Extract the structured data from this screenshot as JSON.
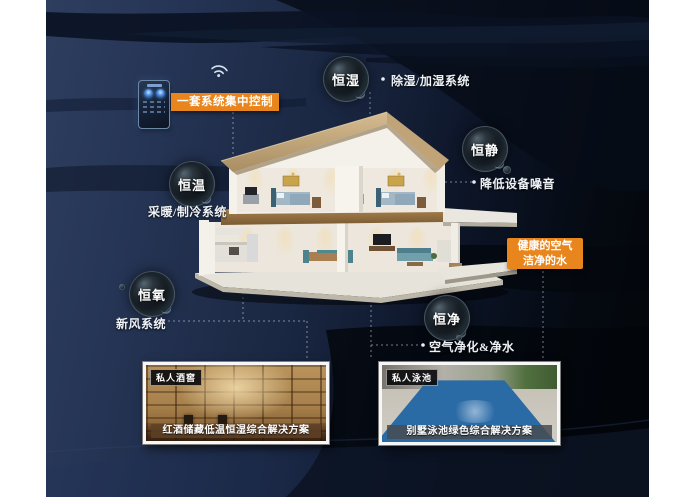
{
  "poster": {
    "control_badge": "一套系统集中控制",
    "health_badge": {
      "line1": "健康的空气",
      "line2": "洁净的水"
    },
    "bubbles": [
      {
        "label": "恒湿",
        "note": "除湿/加湿系统"
      },
      {
        "label": "恒静",
        "note": "降低设备噪音"
      },
      {
        "label": "恒温",
        "note": "采暖/制冷系统"
      },
      {
        "label": "恒氧",
        "note": "新风系统"
      },
      {
        "label": "恒净",
        "note": "空气净化&净水"
      }
    ],
    "cards": [
      {
        "tag": "私人酒窖",
        "caption": "红酒储藏低温恒湿综合解决方案"
      },
      {
        "tag": "私人泳池",
        "caption": "别墅泳池绿色综合解决方案"
      }
    ],
    "icons": {
      "wifi": "wifi-icon",
      "phone": "smart-control-phone"
    },
    "colors": {
      "accent": "#E8851D",
      "navy": "#2E3E5F",
      "black": "#04070C",
      "text": "#FFFFFF"
    }
  }
}
